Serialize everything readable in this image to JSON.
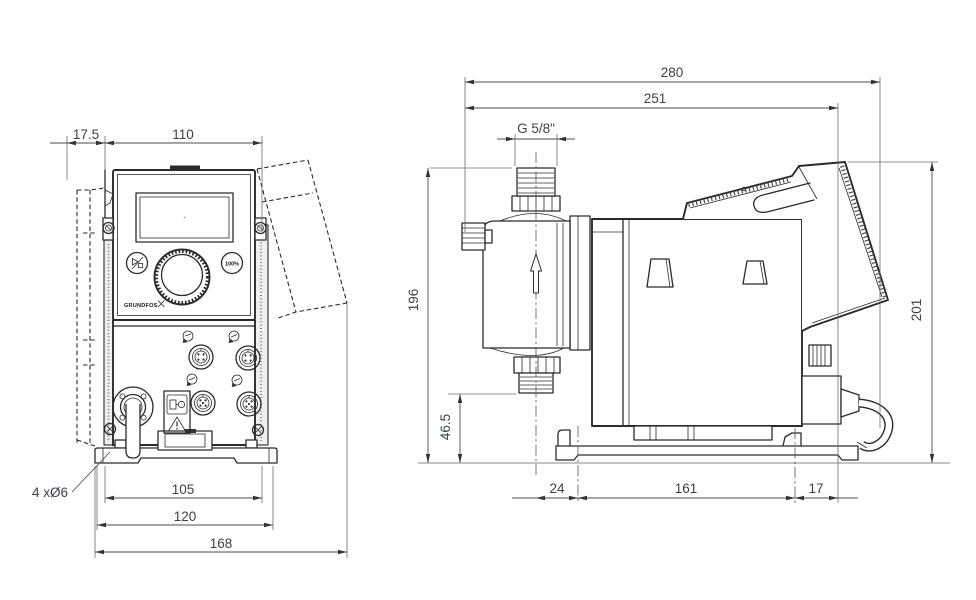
{
  "colors": {
    "line": "#2b2b2b",
    "dim_text": "#3b414b",
    "background": "#ffffff"
  },
  "front_view": {
    "dim_offset_top": "17.5",
    "dim_panel_width": "110",
    "dim_hole_pitch": "105",
    "dim_base_width": "120",
    "dim_overall_width": "168",
    "label_mounting_holes": "4 xØ6",
    "capacity_button_label": "100%",
    "brand": "GRUNDFOS"
  },
  "side_view": {
    "dim_overall_depth": "280",
    "dim_depth_to_cube": "251",
    "label_connection_thread": "G 5/8\"",
    "dim_height_to_connection": "196",
    "dim_suction_height": "46.5",
    "dim_overall_height": "201",
    "dim_base_front_offset": "24",
    "dim_base_hole_pitch": "161",
    "dim_base_rear_offset": "17"
  }
}
